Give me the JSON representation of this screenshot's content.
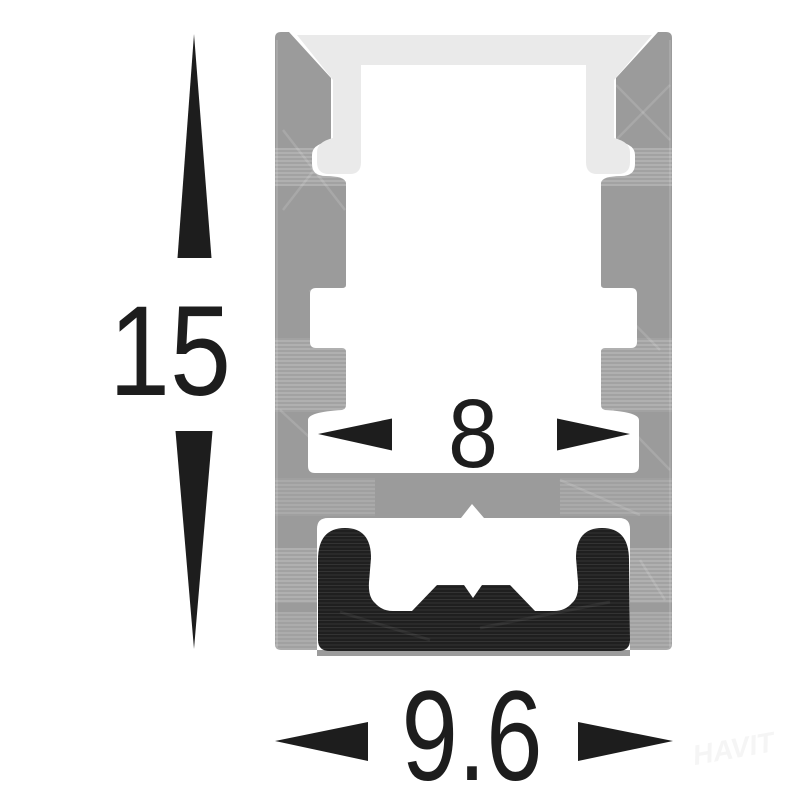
{
  "figure": {
    "type": "cross-section-diagram",
    "subject": "aluminium-led-profile-with-diffuser-and-gasket"
  },
  "dimensions": {
    "height": {
      "value": "15",
      "orientation": "vertical"
    },
    "inner_width": {
      "value": "8",
      "orientation": "horizontal"
    },
    "outer_width": {
      "value": "9.6",
      "orientation": "horizontal"
    }
  },
  "watermark": {
    "text": "HAVIT"
  },
  "colors": {
    "background": "#ffffff",
    "aluminum": "#9b9b9b",
    "diffuser": "#eaeaea",
    "gasket": "#1f1f1f",
    "dimension": "#1d1d1d",
    "watermark": "#f5f5f5"
  },
  "icons": {
    "arrow_up": "dimension-arrow-up-icon",
    "arrow_down": "dimension-arrow-down-icon",
    "arrow_left": "dimension-arrow-left-icon",
    "arrow_right": "dimension-arrow-right-icon"
  }
}
